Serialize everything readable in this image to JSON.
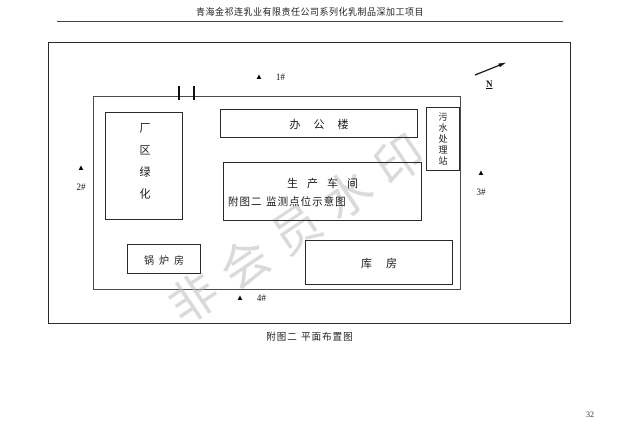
{
  "header": {
    "title": "青海金祁连乳业有限责任公司系列化乳制品深加工项目"
  },
  "footer": {
    "caption": "附图二  平面布置图",
    "page_number": "32"
  },
  "diagram": {
    "compass": {
      "label": "N"
    },
    "marker_icon": "▲",
    "markers": [
      {
        "label": "1#"
      },
      {
        "label": "2#"
      },
      {
        "label": "3#"
      },
      {
        "label": "4#"
      }
    ],
    "buildings": {
      "green_area": "厂区绿化",
      "office": "办公楼",
      "production": "生产车间",
      "production_note": "附图二  监测点位示意图",
      "boiler": "锅炉房",
      "warehouse": "库房",
      "sewage": "污水处理站"
    },
    "watermark": "非会员水印"
  }
}
